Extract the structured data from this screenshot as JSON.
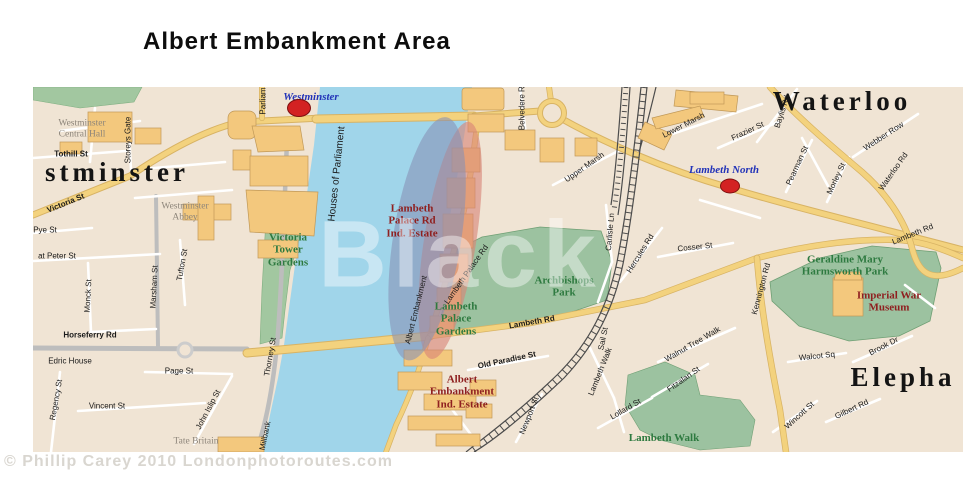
{
  "title": "Albert Embankment Area",
  "watermark": "Black",
  "copyright": "© Phillip Carey 2010 Londonphotoroutes.com",
  "colors": {
    "land": "#f0e4d4",
    "river": "#a0d5ea",
    "park": "#a2c7a0",
    "building": "#f3c87d",
    "main_road": "#f3d27e",
    "highlight_blue": "#8790b5",
    "highlight_red": "#d98578",
    "station_red": "#d32222",
    "station_text": "#2233b8",
    "park_text": "#2e7a40",
    "poi_text": "#8f2020"
  },
  "map": {
    "stations": [
      {
        "name": "Westminster",
        "x": 299,
        "y": 108,
        "w": 22,
        "h": 16
      },
      {
        "name": "Lambeth North",
        "x": 730,
        "y": 186,
        "w": 18,
        "h": 13
      }
    ],
    "labels": {
      "area": [
        {
          "t": "stminster",
          "x": 117,
          "y": 172
        },
        {
          "t": "Waterloo",
          "x": 842,
          "y": 101
        },
        {
          "t": "Elepha",
          "x": 903,
          "y": 377
        }
      ],
      "station": [
        {
          "t": "Westminster",
          "x": 311,
          "y": 97
        },
        {
          "t": "Lambeth North",
          "x": 724,
          "y": 170
        }
      ],
      "park": [
        {
          "t": "Victoria\nTower\nGardens",
          "x": 288,
          "y": 250
        },
        {
          "t": "Lambeth\nPalace\nGardens",
          "x": 456,
          "y": 319
        },
        {
          "t": "Archbishops\nPark",
          "x": 564,
          "y": 287
        },
        {
          "t": "Geraldine Mary\nHarmsworth Park",
          "x": 845,
          "y": 266
        },
        {
          "t": "Lambeth Walk",
          "x": 664,
          "y": 438
        }
      ],
      "poi": [
        {
          "t": "Lambeth\nPalace Rd\nInd. Estate",
          "x": 412,
          "y": 221
        },
        {
          "t": "Albert\nEmbankment\nInd. Estate",
          "x": 462,
          "y": 392
        },
        {
          "t": "Imperial War\nMuseum",
          "x": 889,
          "y": 302
        }
      ],
      "gray": [
        {
          "t": "Westminster\nCentral Hall",
          "x": 82,
          "y": 129
        },
        {
          "t": "Westminster\nAbbey",
          "x": 185,
          "y": 212
        },
        {
          "t": "Tate Britain",
          "x": 196,
          "y": 442
        }
      ],
      "street": [
        {
          "t": "Tothill St",
          "x": 71,
          "y": 155,
          "b": 1
        },
        {
          "t": "Storeys Gate",
          "x": 129,
          "y": 140,
          "r": -90
        },
        {
          "t": "Victoria St",
          "x": 66,
          "y": 204,
          "r": -22,
          "b": 1
        },
        {
          "t": "Pye St",
          "x": 45,
          "y": 231
        },
        {
          "t": "at Peter St",
          "x": 57,
          "y": 257
        },
        {
          "t": "Monck St",
          "x": 89,
          "y": 296,
          "r": -87
        },
        {
          "t": "Marsham St",
          "x": 155,
          "y": 287,
          "r": -87
        },
        {
          "t": "Tufton St",
          "x": 183,
          "y": 265,
          "r": -80
        },
        {
          "t": "Horseferry Rd",
          "x": 90,
          "y": 336,
          "b": 1
        },
        {
          "t": "Edric House",
          "x": 70,
          "y": 362
        },
        {
          "t": "Page St",
          "x": 179,
          "y": 372
        },
        {
          "t": "Vincent St",
          "x": 107,
          "y": 407
        },
        {
          "t": "Regency St",
          "x": 57,
          "y": 400,
          "r": -80
        },
        {
          "t": "John Islip St",
          "x": 209,
          "y": 410,
          "r": -62
        },
        {
          "t": "Millbank",
          "x": 266,
          "y": 436,
          "r": -78
        },
        {
          "t": "Thorney St",
          "x": 271,
          "y": 357,
          "r": -80
        },
        {
          "t": "Houses of Parliament",
          "x": 337,
          "y": 174,
          "r": -84,
          "s": 10
        },
        {
          "t": "Parliam",
          "x": 264,
          "y": 101,
          "r": -90
        },
        {
          "t": "Albert Embankment",
          "x": 417,
          "y": 310,
          "r": -76
        },
        {
          "t": "Lambeth Palace Rd",
          "x": 467,
          "y": 275,
          "r": -55
        },
        {
          "t": "Lambeth Rd",
          "x": 532,
          "y": 323,
          "r": -10,
          "b": 1
        },
        {
          "t": "Lambeth Rd",
          "x": 913,
          "y": 235,
          "r": -22
        },
        {
          "t": "Old Paradise St",
          "x": 507,
          "y": 361,
          "r": -12,
          "b": 1
        },
        {
          "t": "Newport St",
          "x": 530,
          "y": 416,
          "r": -68
        },
        {
          "t": "Carlisle Ln",
          "x": 611,
          "y": 232,
          "r": -85
        },
        {
          "t": "Hercules Rd",
          "x": 641,
          "y": 254,
          "r": -58
        },
        {
          "t": "Cosser St",
          "x": 695,
          "y": 248,
          "r": -6
        },
        {
          "t": "Upper Marsh",
          "x": 585,
          "y": 168,
          "r": -35
        },
        {
          "t": "Belvedere Rd",
          "x": 523,
          "y": 106,
          "r": -90
        },
        {
          "t": "Lower Marsh",
          "x": 684,
          "y": 126,
          "r": -27
        },
        {
          "t": "Frazier St",
          "x": 748,
          "y": 132,
          "r": -25
        },
        {
          "t": "Baylis Rd",
          "x": 783,
          "y": 112,
          "r": -72
        },
        {
          "t": "Pearman St",
          "x": 798,
          "y": 166,
          "r": -65
        },
        {
          "t": "Morley St",
          "x": 837,
          "y": 179,
          "r": -65
        },
        {
          "t": "Webber Row",
          "x": 884,
          "y": 137,
          "r": -33
        },
        {
          "t": "Waterloo Rd",
          "x": 894,
          "y": 172,
          "r": -55
        },
        {
          "t": "Kennington Rd",
          "x": 762,
          "y": 289,
          "r": -75
        },
        {
          "t": "Sail St",
          "x": 604,
          "y": 339,
          "r": -78
        },
        {
          "t": "Lambeth Walk",
          "x": 601,
          "y": 372,
          "r": -68
        },
        {
          "t": "Walnut Tree Walk",
          "x": 693,
          "y": 345,
          "r": -30
        },
        {
          "t": "Fitzalan St",
          "x": 684,
          "y": 380,
          "r": -35
        },
        {
          "t": "Lollard St",
          "x": 626,
          "y": 410,
          "r": -30
        },
        {
          "t": "Walcot Sq",
          "x": 817,
          "y": 357,
          "r": -6
        },
        {
          "t": "Brook Dr",
          "x": 884,
          "y": 347,
          "r": -27
        },
        {
          "t": "Wincott St",
          "x": 800,
          "y": 416,
          "r": -42
        },
        {
          "t": "Gilbert Rd",
          "x": 852,
          "y": 410,
          "r": -25
        }
      ]
    }
  }
}
